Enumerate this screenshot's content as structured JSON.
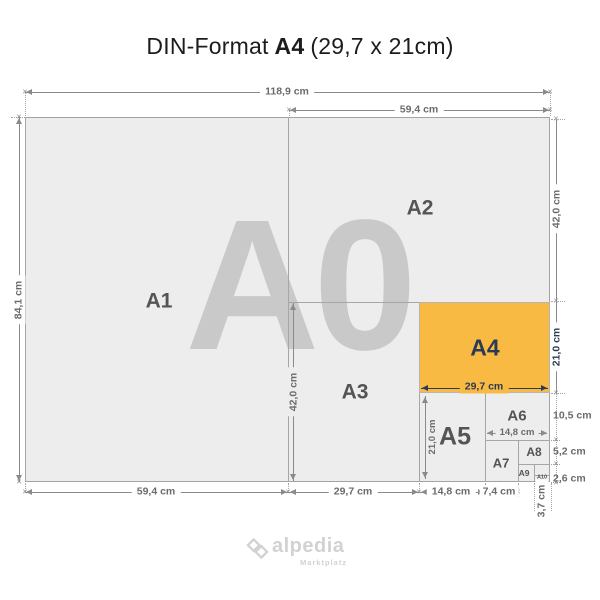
{
  "title": {
    "part1": "DIN-Format",
    "highlight": "A4",
    "part2": "(29,7 x 21cm)"
  },
  "watermark": "A0",
  "format_labels": {
    "a1": "A1",
    "a2": "A2",
    "a3": "A3",
    "a4": "A4",
    "a5": "A5",
    "a6": "A6",
    "a7": "A7",
    "a8": "A8",
    "a9": "A9",
    "a10": "A10"
  },
  "dims": {
    "a0_width": "118,9 cm",
    "a0_height": "84,1 cm",
    "a1_width": "59,4 cm",
    "a2_width": "59,4 cm",
    "a2_height": "42,0 cm",
    "a3_width": "29,7 cm",
    "a3_height": "42,0 cm",
    "a4_width": "29,7 cm",
    "a4_height": "21,0 cm",
    "a5_width": "14,8 cm",
    "a5_height": "21,0 cm",
    "a6_width": "14,8 cm",
    "a6_height": "10,5 cm",
    "a7_width": "7,4 cm",
    "a8_height": "5,2 cm",
    "a9_height": "3,7 cm",
    "a10_height": "2,6 cm"
  },
  "colors": {
    "highlight_fill": "#f8ba42",
    "accent_text": "#2b3a55",
    "sheet_fill": "#ededed",
    "dimension_gray": "#8a8a8a",
    "watermark_gray": "#c9c9c9",
    "logo_gray": "#d2d2d2"
  },
  "ui": {
    "tick": "×"
  },
  "logo": {
    "brand": "alpedia",
    "tagline": "Marktplatz"
  }
}
